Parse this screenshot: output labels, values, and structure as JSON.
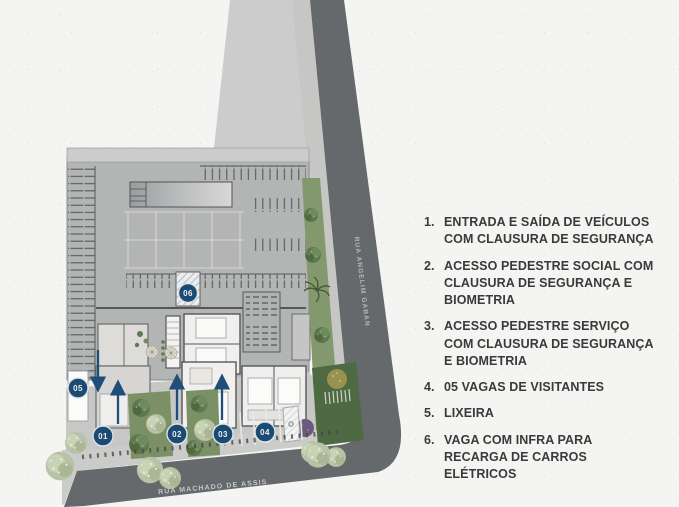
{
  "legend": {
    "items": [
      {
        "number": "1.",
        "text": "ENTRADA E SAÍDA DE VEÍCULOS COM CLAUSURA DE SEGURANÇA"
      },
      {
        "number": "2.",
        "text": "ACESSO PEDESTRE SOCIAL COM CLAUSURA DE SEGURANÇA E BIOMETRIA"
      },
      {
        "number": "3.",
        "text": "ACESSO PEDESTRE SERVIÇO COM CLAUSURA DE SEGURANÇA E BIOMETRIA"
      },
      {
        "number": "4.",
        "text": "05 VAGAS DE VISITANTES"
      },
      {
        "number": "5.",
        "text": "LIXEIRA"
      },
      {
        "number": "6.",
        "text": "VAGA COM INFRA PARA RECARGA DE CARROS ELÉTRICOS"
      }
    ]
  },
  "plan": {
    "streets": {
      "bottom": "RUA MACHADO DE ASSIS",
      "right": "RUA ANGELIM GABAN"
    },
    "markers": [
      {
        "label": "01"
      },
      {
        "label": "02"
      },
      {
        "label": "03"
      },
      {
        "label": "04"
      },
      {
        "label": "05"
      },
      {
        "label": "06"
      }
    ]
  },
  "colors": {
    "marker_navy": "#1c4a71",
    "arrow_navy": "#1f4e78",
    "road_gray": "#65696b",
    "garage_gray": "#b3b4b4",
    "green": "#7b9065",
    "hedge_green": "#4e6a43",
    "legend_text": "#3a3a3a",
    "paper": "#f4f4f2"
  }
}
